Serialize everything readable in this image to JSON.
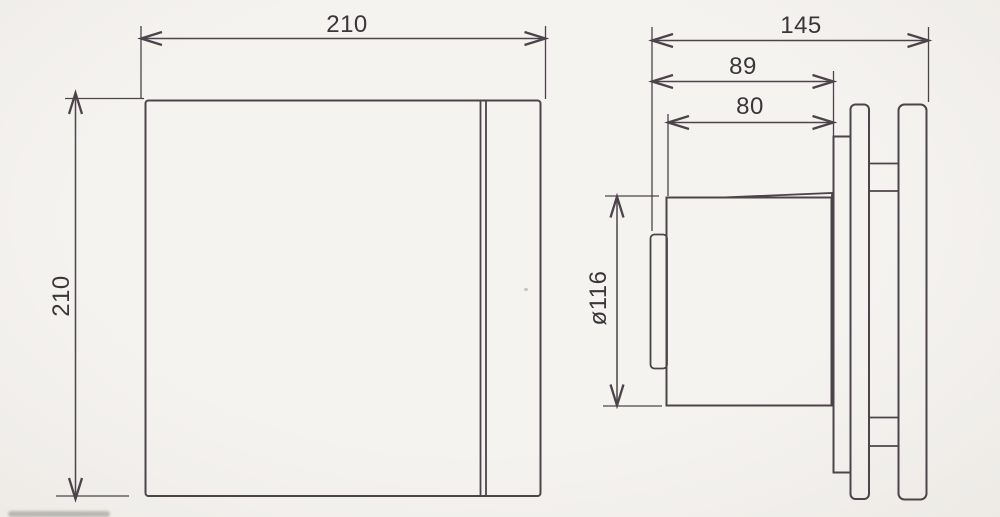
{
  "drawing": {
    "kind": "fan-dimension-drawing",
    "views": {
      "front_view": "front-view",
      "side_view": "side-view"
    }
  },
  "dimensions": {
    "front_width": "210",
    "front_height": "210",
    "depth_total": "145",
    "depth_to_mounting_plate": "89",
    "body_depth": "80",
    "duct_diameter": "ø116"
  },
  "colors": {
    "background": "#f2f0ec",
    "line": "#4c444a",
    "text": "#3c363b"
  }
}
